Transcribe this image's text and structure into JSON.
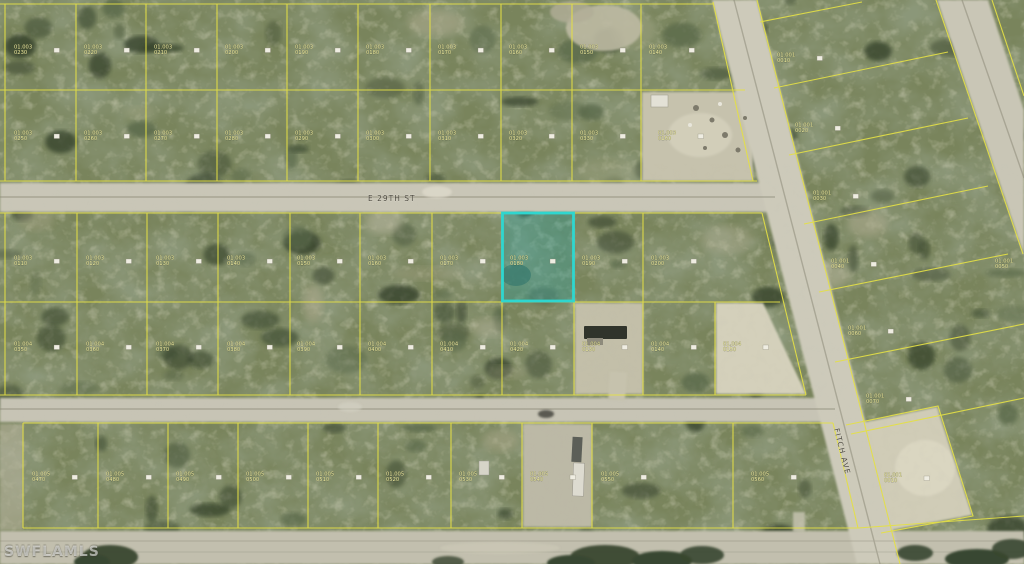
{
  "watermark": {
    "text": "SWFLAMLS"
  },
  "streets": {
    "e29": {
      "label": "E 29TH ST"
    },
    "fitch": {
      "label": "FITCH AVE"
    }
  },
  "highlight": {
    "stroke": "#2fd6cf",
    "fill": "rgba(28,165,170,0.30)"
  },
  "colors": {
    "parcel_line": "#e4e046",
    "label_text": "#f2efa0",
    "marker_fill": "#efede2",
    "street_text": "#4c4940"
  },
  "parcel_labels": [
    {
      "x": 14,
      "y": 44,
      "l1": "01.003",
      "l2": "0230"
    },
    {
      "x": 84,
      "y": 44,
      "l1": "01.003",
      "l2": "0220"
    },
    {
      "x": 154,
      "y": 44,
      "l1": "01.003",
      "l2": "0210"
    },
    {
      "x": 225,
      "y": 44,
      "l1": "01.003",
      "l2": "0200"
    },
    {
      "x": 295,
      "y": 44,
      "l1": "01.003",
      "l2": "0190"
    },
    {
      "x": 366,
      "y": 44,
      "l1": "01.003",
      "l2": "0180"
    },
    {
      "x": 438,
      "y": 44,
      "l1": "01.003",
      "l2": "0170"
    },
    {
      "x": 509,
      "y": 44,
      "l1": "01.003",
      "l2": "0160"
    },
    {
      "x": 580,
      "y": 44,
      "l1": "01.003",
      "l2": "0150"
    },
    {
      "x": 649,
      "y": 44,
      "l1": "01.003",
      "l2": "0140"
    },
    {
      "x": 14,
      "y": 130,
      "l1": "01.003",
      "l2": "0250"
    },
    {
      "x": 84,
      "y": 130,
      "l1": "01.003",
      "l2": "0260"
    },
    {
      "x": 154,
      "y": 130,
      "l1": "01.003",
      "l2": "0270"
    },
    {
      "x": 225,
      "y": 130,
      "l1": "01.003",
      "l2": "0280"
    },
    {
      "x": 295,
      "y": 130,
      "l1": "01.003",
      "l2": "0290"
    },
    {
      "x": 366,
      "y": 130,
      "l1": "01.003",
      "l2": "0300"
    },
    {
      "x": 438,
      "y": 130,
      "l1": "01.003",
      "l2": "0310"
    },
    {
      "x": 509,
      "y": 130,
      "l1": "01.003",
      "l2": "0320"
    },
    {
      "x": 580,
      "y": 130,
      "l1": "01.003",
      "l2": "0330"
    },
    {
      "x": 658,
      "y": 130,
      "l1": "01.003",
      "l2": "0160"
    },
    {
      "x": 14,
      "y": 255,
      "l1": "01.003",
      "l2": "0110"
    },
    {
      "x": 86,
      "y": 255,
      "l1": "01.003",
      "l2": "0120"
    },
    {
      "x": 156,
      "y": 255,
      "l1": "01.003",
      "l2": "0130"
    },
    {
      "x": 227,
      "y": 255,
      "l1": "01.003",
      "l2": "0140"
    },
    {
      "x": 297,
      "y": 255,
      "l1": "01.003",
      "l2": "0150"
    },
    {
      "x": 368,
      "y": 255,
      "l1": "01.003",
      "l2": "0160"
    },
    {
      "x": 440,
      "y": 255,
      "l1": "01.003",
      "l2": "0170"
    },
    {
      "x": 510,
      "y": 255,
      "l1": "01.003",
      "l2": "0180"
    },
    {
      "x": 582,
      "y": 255,
      "l1": "01.003",
      "l2": "0190"
    },
    {
      "x": 651,
      "y": 255,
      "l1": "01.003",
      "l2": "0200"
    },
    {
      "x": 14,
      "y": 341,
      "l1": "01.004",
      "l2": "0350"
    },
    {
      "x": 86,
      "y": 341,
      "l1": "01.004",
      "l2": "0360"
    },
    {
      "x": 156,
      "y": 341,
      "l1": "01.004",
      "l2": "0370"
    },
    {
      "x": 227,
      "y": 341,
      "l1": "01.004",
      "l2": "0380"
    },
    {
      "x": 297,
      "y": 341,
      "l1": "01.004",
      "l2": "0390"
    },
    {
      "x": 368,
      "y": 341,
      "l1": "01.004",
      "l2": "0400"
    },
    {
      "x": 440,
      "y": 341,
      "l1": "01.004",
      "l2": "0410"
    },
    {
      "x": 510,
      "y": 341,
      "l1": "01.004",
      "l2": "0420"
    },
    {
      "x": 582,
      "y": 341,
      "l1": "01.004",
      "l2": "0130"
    },
    {
      "x": 651,
      "y": 341,
      "l1": "01.004",
      "l2": "0140"
    },
    {
      "x": 723,
      "y": 341,
      "l1": "01.004",
      "l2": "0150"
    },
    {
      "x": 32,
      "y": 471,
      "l1": "01.005",
      "l2": "0470"
    },
    {
      "x": 106,
      "y": 471,
      "l1": "01.005",
      "l2": "0480"
    },
    {
      "x": 176,
      "y": 471,
      "l1": "01.005",
      "l2": "0490"
    },
    {
      "x": 246,
      "y": 471,
      "l1": "01.005",
      "l2": "0500"
    },
    {
      "x": 316,
      "y": 471,
      "l1": "01.005",
      "l2": "0510"
    },
    {
      "x": 386,
      "y": 471,
      "l1": "01.005",
      "l2": "0520"
    },
    {
      "x": 459,
      "y": 471,
      "l1": "01.005",
      "l2": "0530"
    },
    {
      "x": 530,
      "y": 471,
      "l1": "01.005",
      "l2": "0540"
    },
    {
      "x": 601,
      "y": 471,
      "l1": "01.005",
      "l2": "0550"
    },
    {
      "x": 751,
      "y": 471,
      "l1": "01.005",
      "l2": "0560"
    },
    {
      "x": 777,
      "y": 52,
      "l1": "01.001",
      "l2": "0010"
    },
    {
      "x": 795,
      "y": 122,
      "l1": "01.001",
      "l2": "0020"
    },
    {
      "x": 813,
      "y": 190,
      "l1": "01.001",
      "l2": "0030"
    },
    {
      "x": 831,
      "y": 258,
      "l1": "01.001",
      "l2": "0040"
    },
    {
      "x": 995,
      "y": 258,
      "l1": "01.001",
      "l2": "0050"
    },
    {
      "x": 848,
      "y": 325,
      "l1": "01.001",
      "l2": "0060"
    },
    {
      "x": 866,
      "y": 393,
      "l1": "01.001",
      "l2": "0070"
    },
    {
      "x": 884,
      "y": 472,
      "l1": "01.001",
      "l2": "0010"
    }
  ]
}
